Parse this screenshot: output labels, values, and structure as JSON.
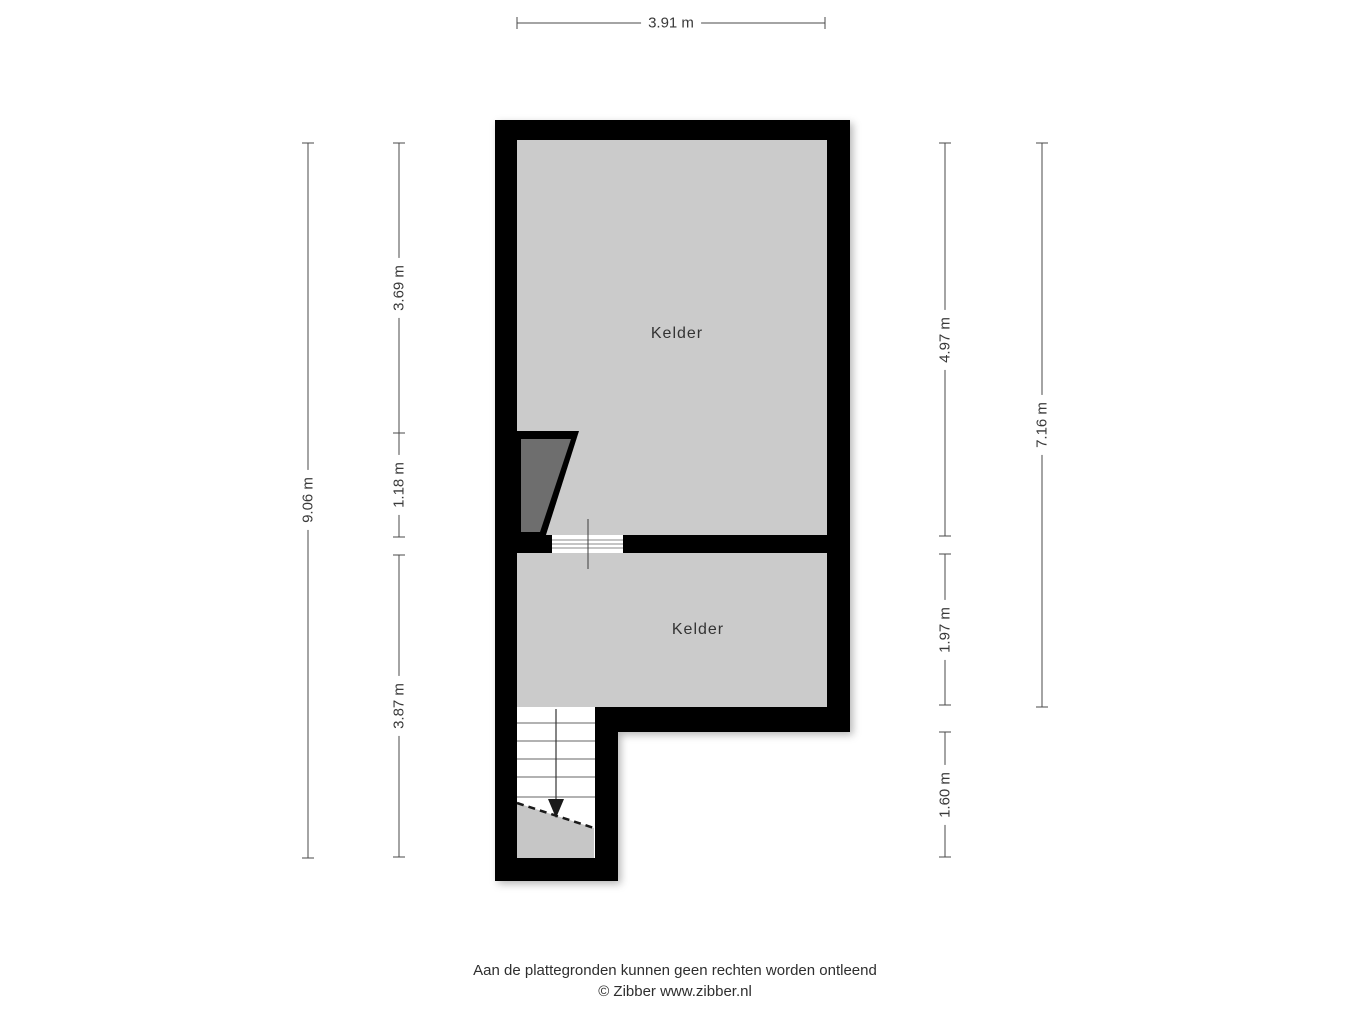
{
  "floorplan": {
    "rooms": [
      {
        "label": "Kelder"
      },
      {
        "label": "Kelder"
      }
    ],
    "dimensions": {
      "top": "3.91 m",
      "left_outer": "9.06 m",
      "left_inner": [
        "3.69 m",
        "1.18 m",
        "3.87 m"
      ],
      "right_inner": [
        "4.97 m",
        "1.97 m",
        "1.60 m"
      ],
      "right_outer": "7.16 m"
    },
    "colors": {
      "wall": "#000000",
      "room_fill": "#cbcbcb",
      "understair_fill": "#c6c6c6",
      "stair_trapezoid_fill": "#6e6e6e",
      "dim_line": "#4a4a4a"
    }
  },
  "footer": {
    "line1": "Aan de plattegronden kunnen geen rechten worden ontleend",
    "line2": "© Zibber www.zibber.nl"
  }
}
